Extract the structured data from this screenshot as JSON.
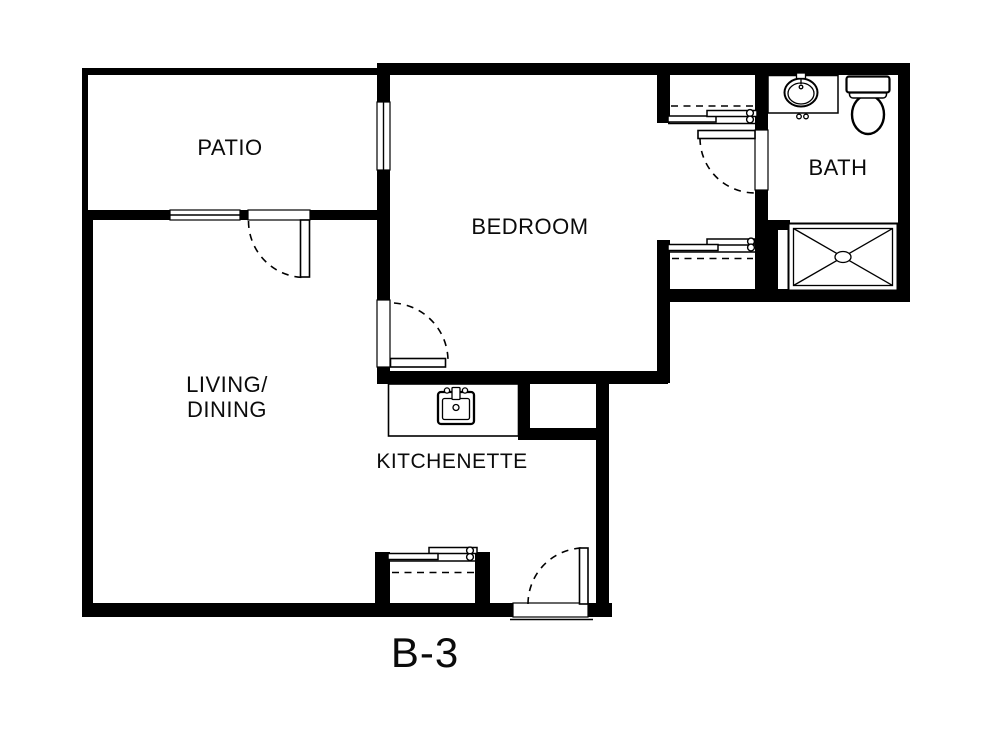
{
  "floor_plan": {
    "unit_label": "B-3",
    "rooms": {
      "patio": {
        "label": "PATIO"
      },
      "bedroom": {
        "label": "BEDROOM"
      },
      "bath": {
        "label": "BATH"
      },
      "living_dining": {
        "line1": "LIVING/",
        "line2": "DINING"
      },
      "kitchenette": {
        "label": "KITCHENETTE"
      }
    },
    "fixtures": {
      "bath": [
        "vanity-sink",
        "toilet",
        "shower"
      ],
      "kitchenette": [
        "kitchen-sink"
      ]
    },
    "features": {
      "doors": [
        "patio-door",
        "bedroom-door",
        "bath-door",
        "entry-door"
      ],
      "closets": [
        "bedroom-closet-north",
        "bedroom-closet-south",
        "entry-closet"
      ],
      "windows": [
        "patio-window",
        "bedroom-window"
      ]
    },
    "colors": {
      "wall": "#000000",
      "background": "#ffffff"
    }
  }
}
